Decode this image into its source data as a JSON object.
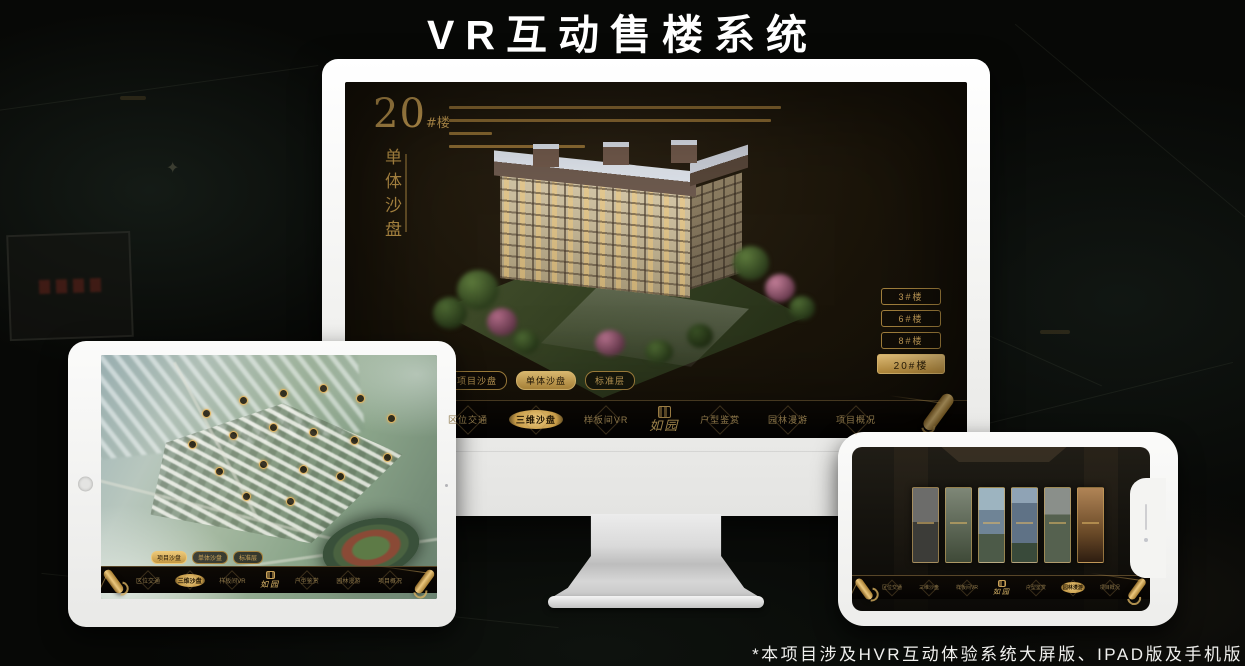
{
  "header": {
    "title": "VR互动售楼系统"
  },
  "footer": {
    "note": "*本项目涉及HVR互动体验系统大屏版、IPAD版及手机版"
  },
  "colors": {
    "accent_gold": "#C9A45C",
    "accent_gold_bright": "#ECC878",
    "device_body": "#F5F5F3",
    "screen_background": "#1A1409"
  },
  "nav": {
    "logo": "如园",
    "items": [
      "区位交通",
      "三维沙盘",
      "样板间VR",
      "户型鉴赏",
      "园林漫游",
      "项目概况"
    ]
  },
  "monitor": {
    "headline_number": "20",
    "headline_suffix": "#楼",
    "headline_section": "单体沙盘",
    "floor_buttons": [
      {
        "label": "3#楼",
        "active": false
      },
      {
        "label": "6#楼",
        "active": false
      },
      {
        "label": "8#楼",
        "active": false
      },
      {
        "label": "20#楼",
        "active": true
      }
    ],
    "view_tabs": [
      {
        "label": "项目沙盘",
        "active": false
      },
      {
        "label": "单体沙盘",
        "active": true
      },
      {
        "label": "标准层",
        "active": false
      }
    ],
    "active_nav_item": "三维沙盘"
  },
  "tablet": {
    "view_tabs": [
      {
        "label": "项目沙盘",
        "active": true
      },
      {
        "label": "单体沙盘",
        "active": false
      },
      {
        "label": "标准层",
        "active": false
      }
    ],
    "active_nav_item": "三维沙盘"
  },
  "phone": {
    "active_nav_item": "园林漫游"
  }
}
